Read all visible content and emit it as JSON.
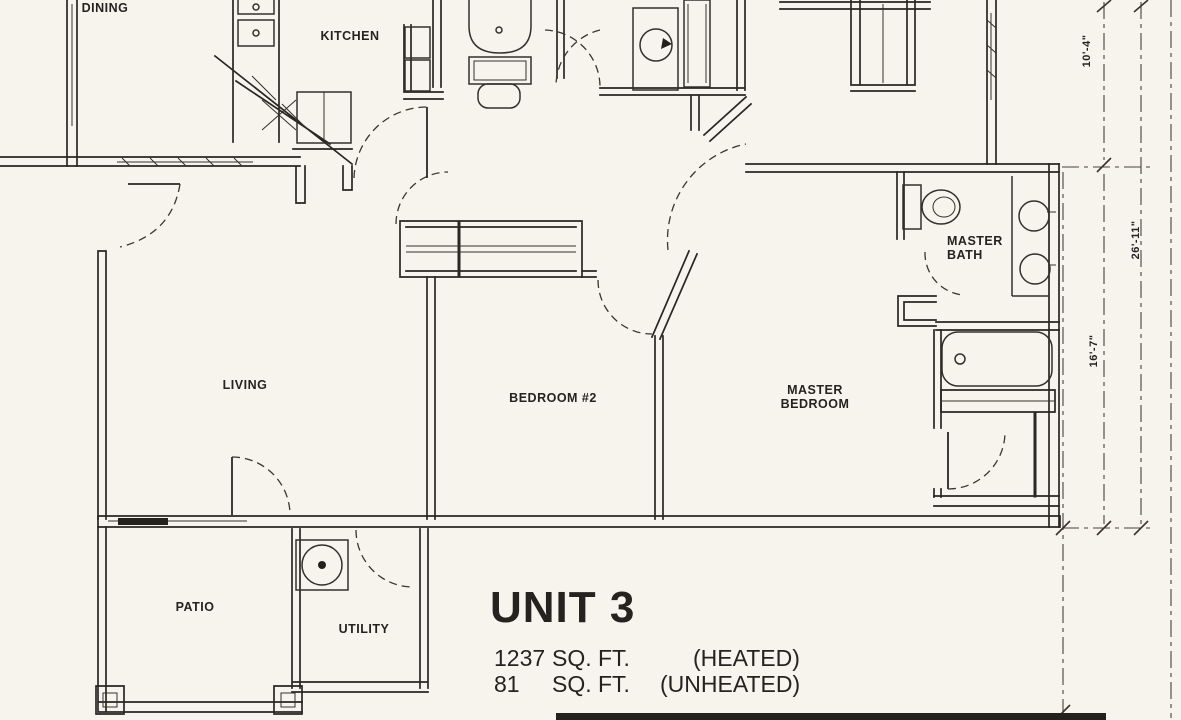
{
  "plan": {
    "unit_title": "UNIT 3",
    "heated_value": "1237",
    "heated_unit": "SQ. FT.",
    "heated_note": "(HEATED)",
    "unheated_value": "81",
    "unheated_unit": "SQ. FT.",
    "unheated_note": "(UNHEATED)"
  },
  "rooms": {
    "dining": "DINING",
    "kitchen": "KITCHEN",
    "living": "LIVING",
    "bedroom2": "BEDROOM #2",
    "master_bedroom": {
      "line1": "MASTER",
      "line2": "BEDROOM"
    },
    "master_bath": {
      "line1": "MASTER",
      "line2": "BATH"
    },
    "patio": "PATIO",
    "utility": "UTILITY"
  },
  "dimensions": {
    "top_right_height": "10'-4\"",
    "right_overall_height": "26'-11\"",
    "right_lower_height": "16'-7\""
  },
  "colors": {
    "ink": "#262320",
    "paper": "#f7f4ee"
  }
}
